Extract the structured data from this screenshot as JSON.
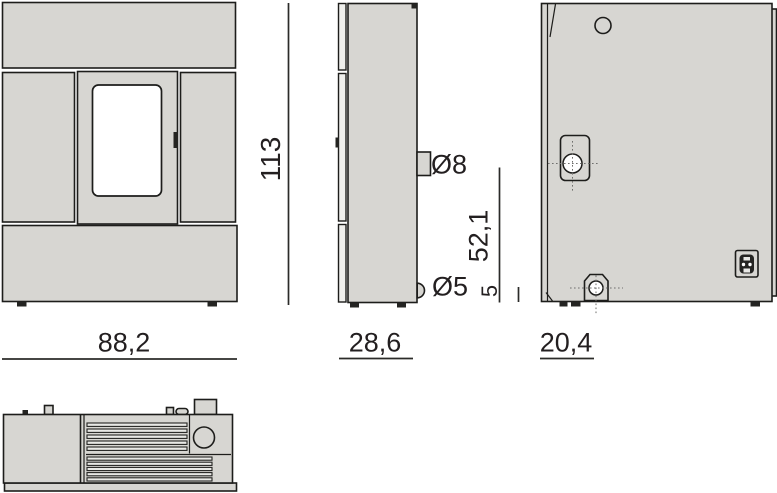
{
  "labels": {
    "height_cm": "113",
    "front_width_cm": "88,2",
    "side_depth_cm": "28,6",
    "flue_offset_cm": "20,4",
    "flue_height_cm": "52,1",
    "air_intake_height_cm": "5",
    "flue_diameter": "Ø8",
    "air_intake_diameter": "Ø5"
  },
  "colors": {
    "panel": "#d7d6d2",
    "panel_light": "#efefec",
    "outline": "#1d1d1b",
    "text": "#231f20",
    "background": "#ffffff"
  }
}
